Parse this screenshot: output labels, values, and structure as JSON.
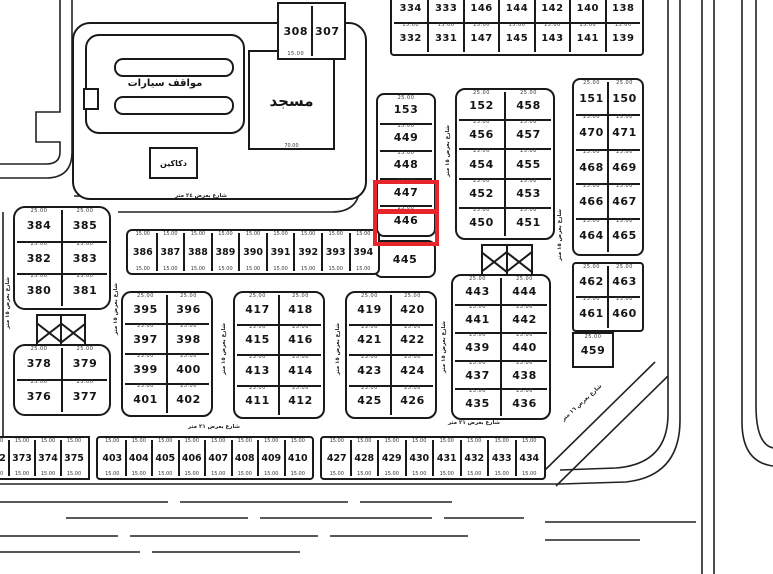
{
  "map": {
    "highlight_color": "#e8252a",
    "line_color": "#1a1a1a",
    "dim_pair": "25.00",
    "dim_strip": "15.00",
    "dim_mosque": "70.00",
    "highlighted_plots": [
      "447",
      "446"
    ]
  },
  "labels": {
    "parking": "مواقف سيارات",
    "mosque": "مسجد",
    "shops": "دكاكين",
    "street_h_top": "شارع بعرض ٢٤ متر",
    "street_h_bottom": "شارع بعرض ٢١ متر",
    "street_v": "شارع بعرض ١٥ متر",
    "street_diag": "شارع بعرض ١٦ متر"
  },
  "blocks": {
    "top_strip_row1": [
      "334",
      "333",
      "146",
      "144",
      "142",
      "140",
      "138"
    ],
    "top_strip_row2": [
      "332",
      "331",
      "147",
      "145",
      "143",
      "141",
      "139"
    ],
    "block_308": [
      [
        "308",
        "307"
      ]
    ],
    "center_column": [
      "153",
      "449",
      "448",
      "447",
      "446"
    ],
    "plot_445": "445",
    "plot_459": "459",
    "block_452": [
      [
        "152",
        "458"
      ],
      [
        "456",
        "457"
      ],
      [
        "454",
        "455"
      ],
      [
        "452",
        "453"
      ],
      [
        "450",
        "451"
      ]
    ],
    "right_col_upper": [
      [
        "151",
        "150"
      ],
      [
        "470",
        "471"
      ],
      [
        "468",
        "469"
      ],
      [
        "466",
        "467"
      ],
      [
        "464",
        "465"
      ]
    ],
    "right_col_lower": [
      [
        "462",
        "463"
      ],
      [
        "461",
        "460"
      ]
    ],
    "left_a": [
      [
        "384",
        "385"
      ],
      [
        "382",
        "383"
      ],
      [
        "380",
        "381"
      ]
    ],
    "left_b": [
      [
        "378",
        "379"
      ],
      [
        "376",
        "377"
      ]
    ],
    "mid_strip": [
      "386",
      "387",
      "388",
      "389",
      "390",
      "391",
      "392",
      "393",
      "394"
    ],
    "block_395": [
      [
        "395",
        "396"
      ],
      [
        "397",
        "398"
      ],
      [
        "399",
        "400"
      ],
      [
        "401",
        "402"
      ]
    ],
    "block_417": [
      [
        "417",
        "418"
      ],
      [
        "415",
        "416"
      ],
      [
        "413",
        "414"
      ],
      [
        "411",
        "412"
      ]
    ],
    "block_419": [
      [
        "419",
        "420"
      ],
      [
        "421",
        "422"
      ],
      [
        "423",
        "424"
      ],
      [
        "425",
        "426"
      ]
    ],
    "block_443": [
      [
        "443",
        "444"
      ],
      [
        "441",
        "442"
      ],
      [
        "439",
        "440"
      ],
      [
        "437",
        "438"
      ],
      [
        "435",
        "436"
      ]
    ],
    "bottom_a": [
      "372",
      "373",
      "374",
      "375"
    ],
    "bottom_b": [
      "403",
      "404",
      "405",
      "406",
      "407",
      "408",
      "409",
      "410"
    ],
    "bottom_c": [
      "427",
      "428",
      "429",
      "430",
      "431",
      "432",
      "433",
      "434"
    ]
  }
}
